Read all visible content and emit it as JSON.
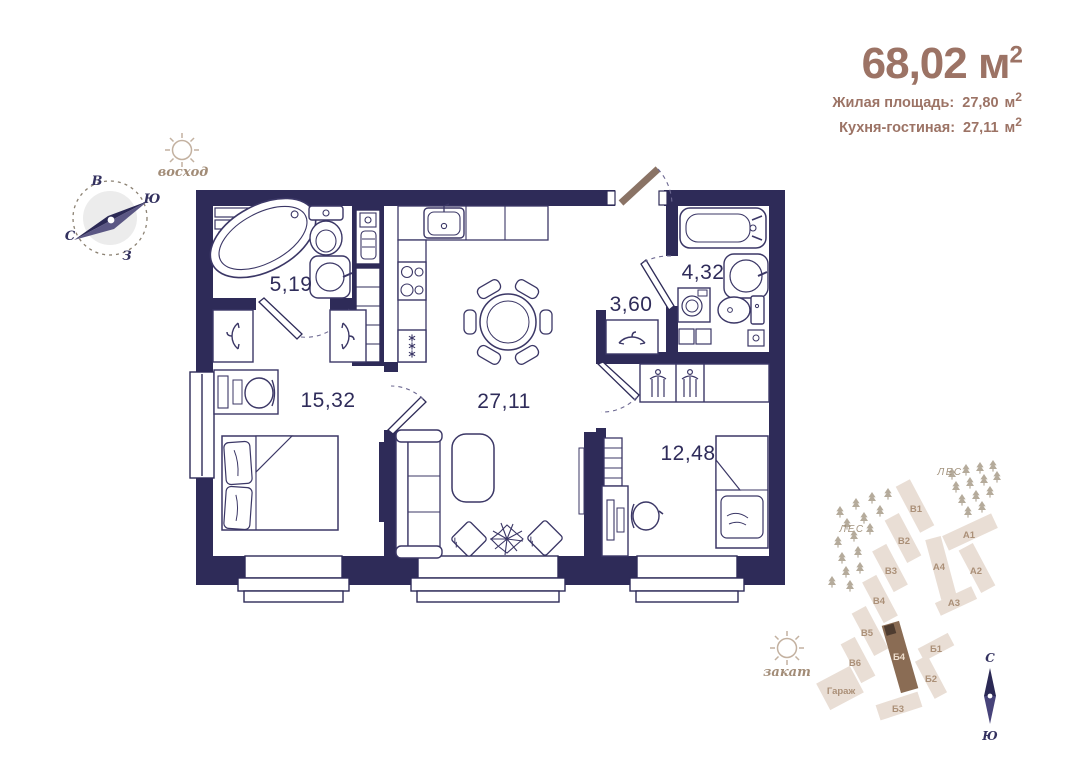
{
  "header": {
    "total": {
      "value": "68,02",
      "unit": "м",
      "exp": "2"
    },
    "details": [
      {
        "label": "Жилая площадь:",
        "value": "27,80",
        "unit": "м",
        "exp": "2"
      },
      {
        "label": "Кухня-гостиная:",
        "value": "27,11",
        "unit": "м",
        "exp": "2"
      }
    ]
  },
  "sun": {
    "sunrise": "восход",
    "sunset": "закат"
  },
  "main_compass": {
    "top": "В",
    "right": "Ю",
    "left": "С",
    "bottom": "З"
  },
  "rooms": {
    "bathroom_small": "5,19",
    "bedroom": "15,32",
    "kitchen_living": "27,11",
    "hallway": "3,60",
    "bathroom": "4,32",
    "bedroom_second": "12,48"
  },
  "siteplan": {
    "forest_label_1": "ЛЕС",
    "forest_label_2": "ЛЕС",
    "buildings": [
      {
        "label": "В1"
      },
      {
        "label": "В2"
      },
      {
        "label": "В3"
      },
      {
        "label": "В4"
      },
      {
        "label": "В5"
      },
      {
        "label": "В6"
      },
      {
        "label": "А1"
      },
      {
        "label": "А2"
      },
      {
        "label": "А3"
      },
      {
        "label": "А4"
      },
      {
        "label": "Б1"
      },
      {
        "label": "Б2"
      },
      {
        "label": "Б3"
      },
      {
        "label": "Б4",
        "highlighted": true
      },
      {
        "label": "Гараж"
      }
    ],
    "compass": {
      "top": "С",
      "bottom": "Ю"
    }
  },
  "colors": {
    "wall": "#2e2b58",
    "accent_brown": "#9c7365",
    "building_beige": "#e9ded5",
    "building_highlight": "#8a6c54",
    "door_leaf": "#8a7365"
  }
}
